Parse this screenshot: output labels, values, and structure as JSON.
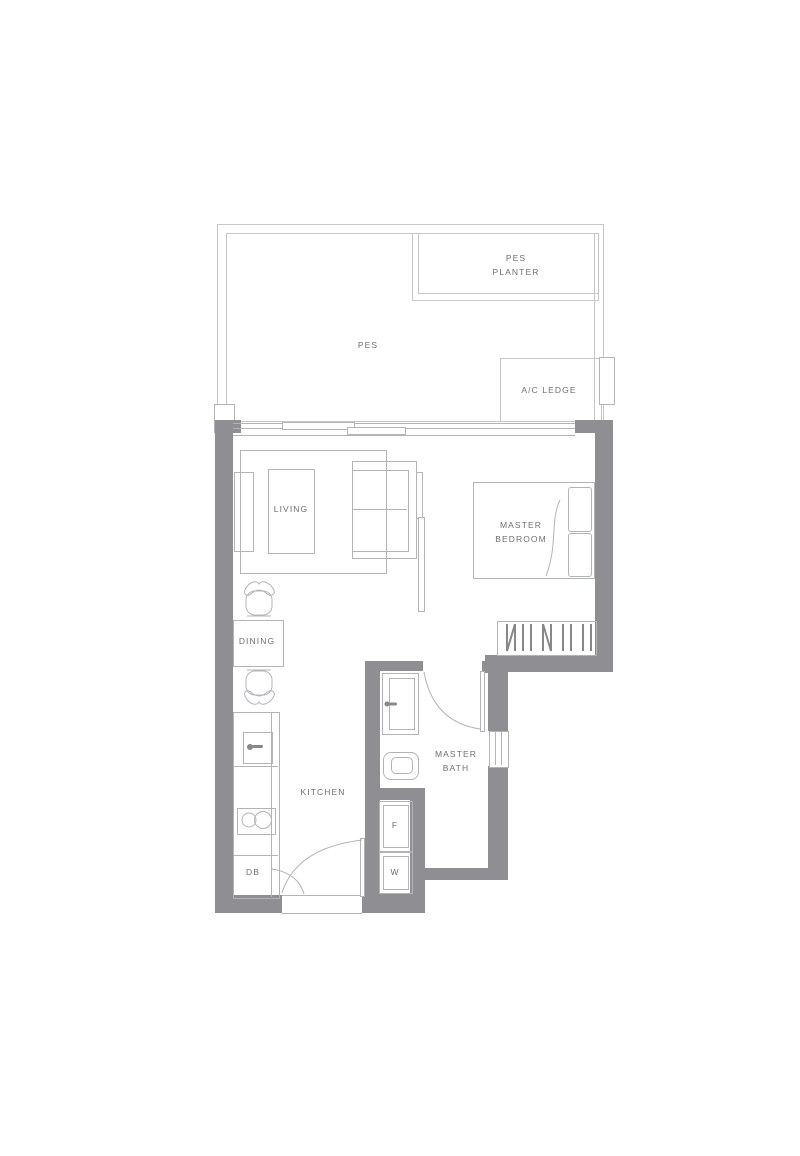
{
  "plan": {
    "type": "apartment-floor-plan",
    "rooms": {
      "pes_planter": {
        "line1": "PES",
        "line2": "PLANTER"
      },
      "pes": {
        "label": "PES"
      },
      "ac_ledge": {
        "label": "A/C LEDGE"
      },
      "living": {
        "label": "LIVING"
      },
      "master_bedroom": {
        "line1": "MASTER",
        "line2": "BEDROOM"
      },
      "dining": {
        "label": "DINING"
      },
      "kitchen": {
        "label": "KITCHEN"
      },
      "master_bath": {
        "line1": "MASTER",
        "line2": "BATH"
      }
    },
    "appliances": {
      "fridge": {
        "label": "F"
      },
      "washer": {
        "label": "W"
      },
      "db": {
        "label": "DB"
      }
    },
    "colors": {
      "wall": "#8e8e93",
      "furniture_line": "#b3b4b8",
      "boundary_line": "#c6c7cb",
      "text": "#6e6f73",
      "background": "#ffffff"
    }
  }
}
